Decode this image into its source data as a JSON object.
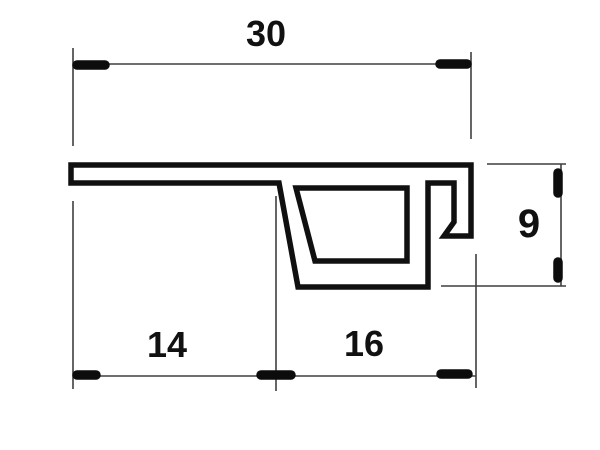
{
  "drawing": {
    "type": "technical-profile-cross-section",
    "background_color": "#ffffff",
    "profile_line_color": "#101010",
    "dimension_line_color": "#3f3f3f",
    "dimensions": {
      "total_width": "30",
      "bottom_left_segment": "14",
      "bottom_right_segment": "16",
      "right_height": "9"
    }
  }
}
